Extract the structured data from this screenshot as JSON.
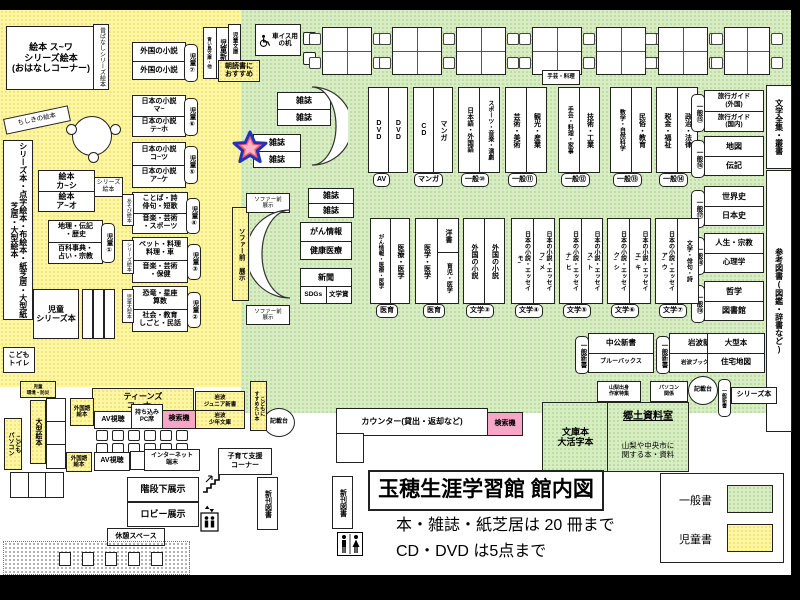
{
  "title": {
    "main": "玉穂生涯学習館 館内図",
    "line2": "本・雑誌・紙芝居は 20 冊まで",
    "line3": "CD・DVD は5点まで"
  },
  "legend": {
    "general": "一般書",
    "children": "児童書",
    "general_color": "#d8edc4",
    "children_color": "#fdf6a3"
  },
  "children_area": {
    "ohanashi": "絵本 ス~ワ\nシリーズ絵本\n(おはなしコーナー)",
    "mukashibanashi": "昔ばなしシリーズ絵本",
    "chishiki": "ちしきの絵本",
    "tall_left": "シリーズ本・点字絵本・布絵本・紙芝居・大型紙芝居・大型絵本",
    "ehon_top": "絵本\nカ~シ",
    "ehon_bottom": "絵本\nア~オ",
    "series_ehon": "シリーズ絵本",
    "chiri": "地理・伝記\n・歴史",
    "hyakka": "百科事典・\n占い・宗教",
    "jido1": "児童①",
    "gaikoku_shosetsu": "外国の小説",
    "jido7": "児童⑦",
    "jido_shinsho": "児童新書",
    "aoitori": "青い鳥文庫・他",
    "jido_bunko": "児童文庫",
    "asadoku": "朝読書に\nおすすめ",
    "jp_ma": "日本の小説\nマ~",
    "jp_te": "日本の小説\nテ~ホ",
    "jido6": "児童⑥",
    "jp_ko": "日本の小説\nコ~ツ",
    "jp_a": "日本の小説\nア~ケ",
    "jido5": "児童⑤",
    "kotoba": "ことば・詩\n俳句・短歌",
    "ongaku_sports": "音楽・芸術\n・スポーツ",
    "asobi_ehon": "あそび絵本",
    "jido4": "児童④",
    "pet": "ペット・料理\n料理・車",
    "ongaku_hoken": "音楽・芸術\n・保健",
    "series_ehon2": "シリーズ絵本",
    "jido3": "児童③",
    "kyoryu": "恐竜・星座\n算数",
    "shakai": "社会・教育\nしごと・民話",
    "jido_ogata": "児童大型本",
    "jido2": "児童②",
    "jido_series": "児童\nシリーズ本",
    "kodomo_toilet": "こども\nトイレ",
    "sofa_vertical": "ソファー前 展示",
    "sofa_box": "ソファー前\n展示",
    "kankyo": "児童\n環境・防災",
    "ogata_ehon": "大型絵本",
    "kodomo_pc": "こども\nパソコン"
  },
  "facilities": {
    "wheelchair_desk": "車イス用\nの机",
    "teens": "ティーンズ\nコーナー",
    "gaikokugo_ehon": "外国語\n絵本",
    "av": "AV視聴",
    "pc_seat": "持ち込み\nPC席",
    "kensakuki": "検索機",
    "iwanami_jr": "岩波\nジュニア新書",
    "iwanami_shonen": "岩波\n少年文庫",
    "internet": "インターネット\n端末",
    "kosodate": "子育て支援\nコーナー",
    "kaidan": "階段下展示",
    "lobby": "ロビー展示",
    "kyukei": "休憩スペース",
    "counter": "カウンター(貸出・返却など)",
    "kisaidai": "記載台",
    "shinkan": "新刊図書",
    "kodomoni": "こどもに\nすすめたい本"
  },
  "general_area": {
    "zasshi": "雑誌",
    "gan": "がん情報",
    "kenko": "健康医療",
    "shimbun": "新聞",
    "sdgs": "SDGs",
    "bungakusho": "文学賞",
    "tegei_small": "手芸・料理",
    "row1": [
      {
        "c1": "DVD",
        "c2": "DVD",
        "tag": "AV"
      },
      {
        "c1": "CD",
        "c2": "マンガ",
        "tag": "マンガ"
      },
      {
        "c1": "日本語・外国語",
        "c2": "スポーツ・音楽・演劇",
        "tag": "一般⑩"
      },
      {
        "c1": "芸術・美術",
        "c2": "観光・産業",
        "tag": "一般⑪"
      },
      {
        "c1": "手芸・料理・家事",
        "c2": "技術・工業",
        "tag": "一般⑫"
      },
      {
        "c1": "数学・自然科学",
        "c2": "民俗・教育",
        "tag": "一般⑬"
      },
      {
        "c1": "税金・福祉",
        "c2": "政治・法律",
        "tag": "一般⑭"
      }
    ],
    "row2": [
      {
        "c1": "がん情報・医療・医学",
        "c2": "医療・医学",
        "tag": "医育"
      },
      {
        "c1": "医学・医学",
        "c2a": "洋書",
        "c2b": "育児・医学",
        "tag": "医育"
      },
      {
        "c1": "外国の小説",
        "c2": "外国の小説",
        "tag": "文学③"
      },
      {
        "c1": "日本の小説・エッセイ\nモ~",
        "c2": "日本の小説・エッセイ\nフ~メ",
        "tag": "文学④"
      },
      {
        "c1": "日本の小説・エッセイ\nナ~ヒ",
        "c2": "日本の小説・エッセイ\nス~ト",
        "tag": "文学⑤"
      },
      {
        "c1": "日本の小説・エッセイ\nク~シ",
        "c2": "日本の小説・エッセイ\nエ~キ",
        "tag": "文学⑥"
      },
      {
        "c1": "日本の小説・エッセイ\nア~ウ",
        "c2": "文学・俳句・詩",
        "tag": "文学⑦"
      }
    ],
    "side": [
      {
        "t": "旅行ガイド\n(外国)",
        "b": "旅行ガイド\n(国内)",
        "tag": "一般⑮"
      },
      {
        "t": "地図",
        "b": "伝記",
        "tag": "一般⑯"
      },
      {
        "t": "世界史",
        "b": "日本史",
        "tag": "一般⑰"
      },
      {
        "t": "人生・宗教",
        "b": "心理学",
        "tag": "一般⑱"
      },
      {
        "t": "哲学",
        "b": "図書館",
        "tag": "一般⑲"
      }
    ],
    "bungaku_zenshu": "文学全集・叢書",
    "sanko": "参考図書(図鑑・辞書など)",
    "chuko": "中公新書",
    "bluebacks": "ブルーバックス",
    "shinsho_v": "一般新書",
    "iwanami_shinsho": "岩波新書",
    "iwanami_booklet": "岩波ブックレット",
    "ogata_bon": "大型本",
    "jutaku": "住宅地図",
    "yamanashi": "山梨出身\n作家特集",
    "pc_kankei": "パソコン\n関係",
    "series_bon": "シリーズ本",
    "bunko": "文庫本\n大活字本",
    "kyodo_title": "郷土資料室",
    "kyodo_desc": "山梨や中央市に\n関する本・資料"
  }
}
